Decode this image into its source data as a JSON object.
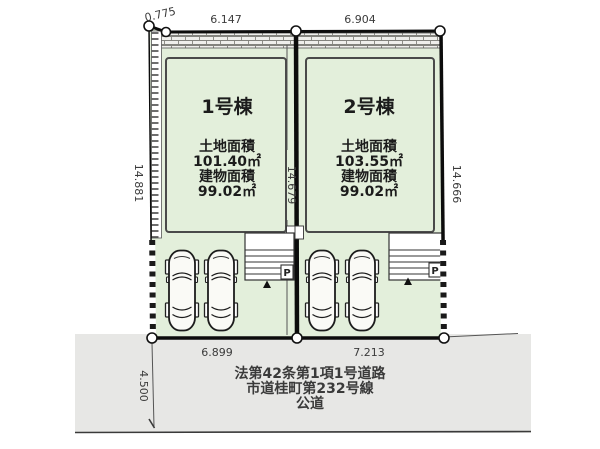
{
  "plan": {
    "dims": {
      "top_bevel": "0.775",
      "lot1_top_width": "6.147",
      "lot2_top_width": "6.904",
      "left_height": "14.881",
      "middle_height": "14.679",
      "right_height": "14.666",
      "lot1_bottom_width": "6.899",
      "lot2_bottom_width": "7.213",
      "road_width": "4.500"
    },
    "lot1": {
      "name": "1号棟",
      "land_area_label": "土地面積",
      "land_area_value": "101.40㎡",
      "building_area_label": "建物面積",
      "building_area_value": "99.02㎡",
      "parking_mark": "P"
    },
    "lot2": {
      "name": "2号棟",
      "land_area_label": "土地面積",
      "land_area_value": "103.55㎡",
      "building_area_label": "建物面積",
      "building_area_value": "99.02㎡",
      "parking_mark": "P"
    },
    "road": {
      "line1": "法第42条第1項1号道路",
      "line2": "市道桂町第232号線",
      "line3": "公道"
    },
    "colors": {
      "lot_fill": "#e3efdb",
      "road_fill": "#e7e7e5",
      "line_color": "#111111"
    }
  }
}
